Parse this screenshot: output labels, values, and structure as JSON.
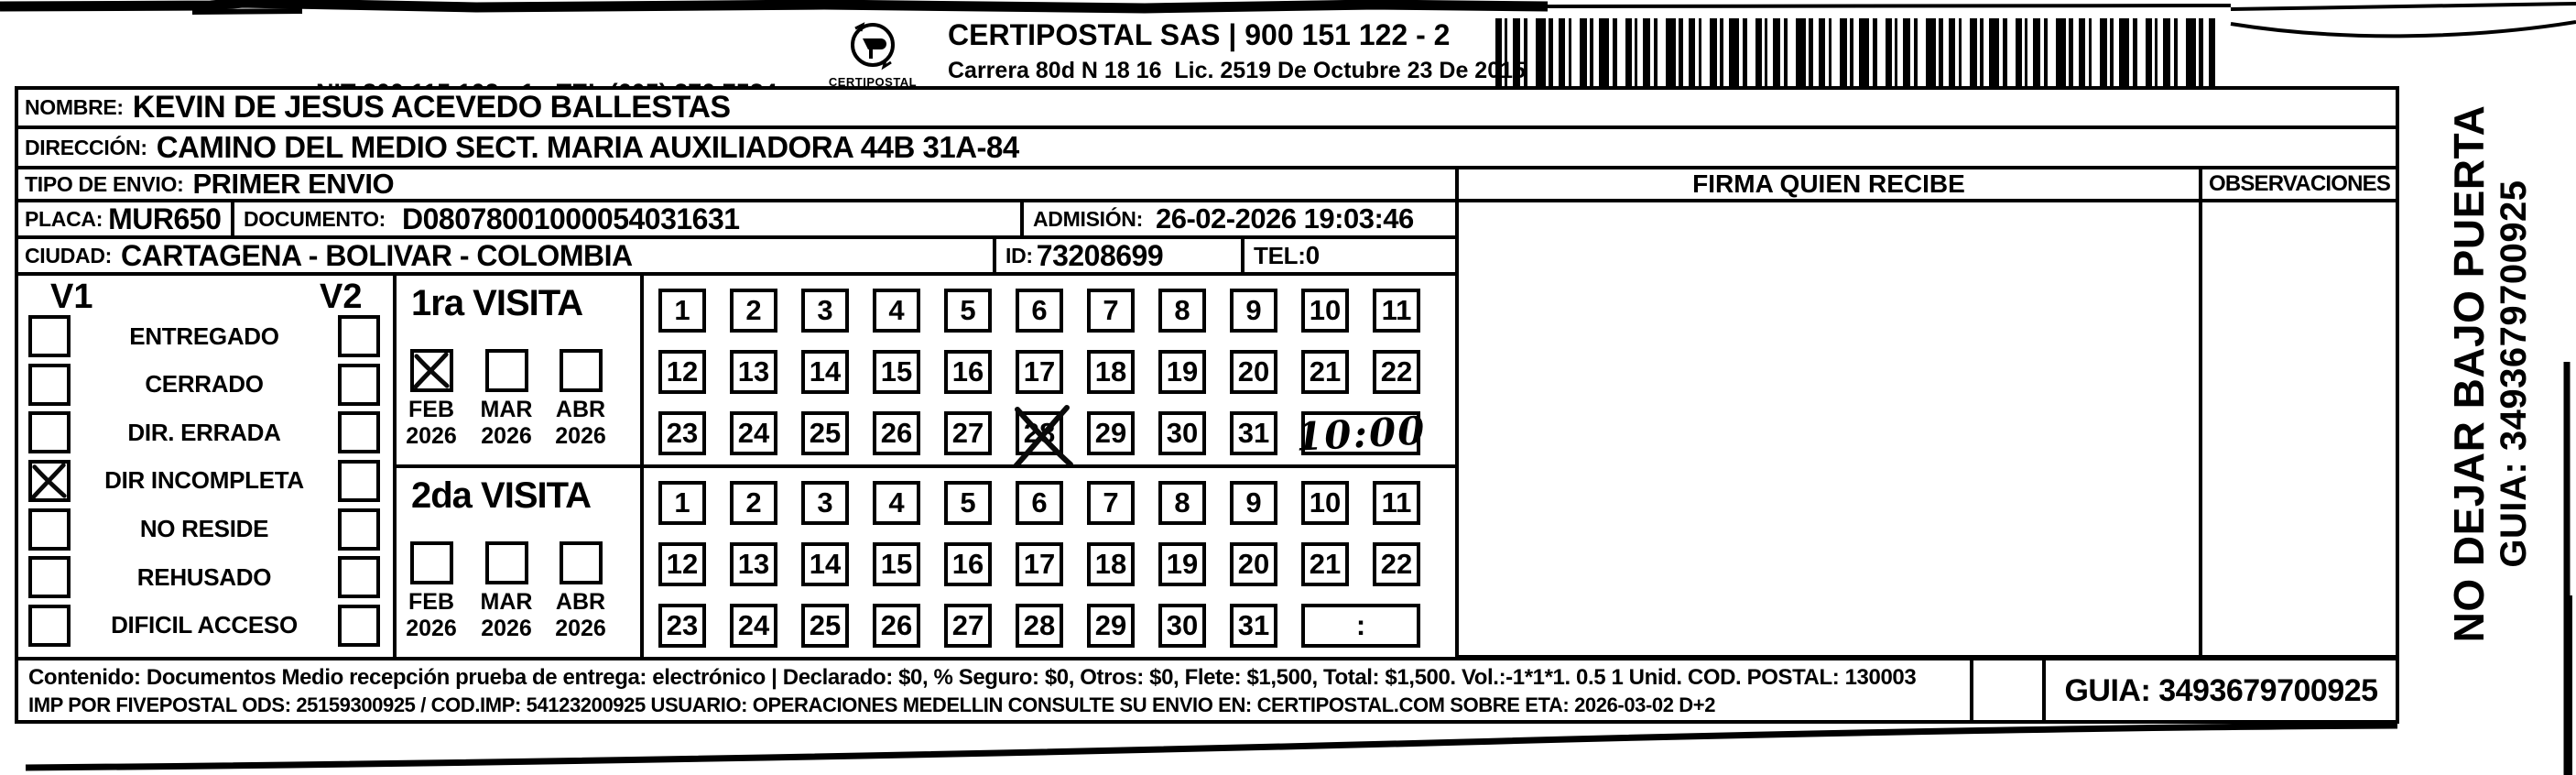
{
  "header": {
    "sender_line1": "TRANSITO DEL",
    "sender_line2": "ATLANTICO",
    "nit_line": "NIT 800 115 102 - 1 - TEL (605) 370 7534",
    "address_line": "CALLE 40 No. 45 06 BARRANQUILLA ATLATICO",
    "logo_text": "CERTIPOSTAL",
    "carrier_line1": "CERTIPOSTAL SAS | 900 151 122 - 2",
    "carrier_line2": "Carrera 80d N 18 16  Lic. 2519 De Octubre 23 De 2015"
  },
  "recipient": {
    "nombre_label": "NOMBRE:",
    "nombre": "KEVIN DE JESUS ACEVEDO BALLESTAS",
    "direccion_label": "DIRECCIÓN:",
    "direccion": "CAMINO DEL MEDIO SECT. MARIA AUXILIADORA 44B 31A-84",
    "tipo_envio_label": "TIPO DE ENVIO:",
    "tipo_envio": "PRIMER ENVIO",
    "placa_label": "PLACA:",
    "placa": "MUR650",
    "documento_label": "DOCUMENTO:",
    "documento": "D08078001000054031631",
    "admision_label": "ADMISIÓN:",
    "admision": "26-02-2026 19:03:46",
    "ciudad_label": "CIUDAD:",
    "ciudad": "CARTAGENA - BOLIVAR - COLOMBIA",
    "id_label": "ID:",
    "id": "73208699",
    "tel_label": "TEL:",
    "tel": "0"
  },
  "columns": {
    "firma_header": "FIRMA QUIEN RECIBE",
    "observaciones_header": "OBSERVACIONES"
  },
  "status": {
    "v1_label": "V1",
    "v2_label": "V2",
    "options": [
      {
        "label": "ENTREGADO",
        "v1_checked": false,
        "v2_checked": false
      },
      {
        "label": "CERRADO",
        "v1_checked": false,
        "v2_checked": false
      },
      {
        "label": "DIR. ERRADA",
        "v1_checked": false,
        "v2_checked": false
      },
      {
        "label": "DIR INCOMPLETA",
        "v1_checked": true,
        "v2_checked": false
      },
      {
        "label": "NO RESIDE",
        "v1_checked": false,
        "v2_checked": false
      },
      {
        "label": "REHUSADO",
        "v1_checked": false,
        "v2_checked": false
      },
      {
        "label": "DIFICIL ACCESO",
        "v1_checked": false,
        "v2_checked": false
      }
    ]
  },
  "visits": [
    {
      "title": "1ra VISITA",
      "months": [
        {
          "month": "FEB",
          "year": "2026",
          "checked": true
        },
        {
          "month": "MAR",
          "year": "2026",
          "checked": false
        },
        {
          "month": "ABR",
          "year": "2026",
          "checked": false
        }
      ],
      "crossed_day": 28,
      "time_written": "10:00"
    },
    {
      "title": "2da VISITA",
      "months": [
        {
          "month": "FEB",
          "year": "2026",
          "checked": false
        },
        {
          "month": "MAR",
          "year": "2026",
          "checked": false
        },
        {
          "month": "ABR",
          "year": "2026",
          "checked": false
        }
      ],
      "crossed_day": null,
      "time_written": ""
    }
  ],
  "calendar": {
    "rows": [
      [
        1,
        2,
        3,
        4,
        5,
        6,
        7,
        8,
        9,
        10,
        11
      ],
      [
        12,
        13,
        14,
        15,
        16,
        17,
        18,
        19,
        20,
        21,
        22
      ],
      [
        23,
        24,
        25,
        26,
        27,
        28,
        29,
        30,
        31
      ]
    ],
    "time_placeholder": ":"
  },
  "side_note": {
    "line1": "NO DEJAR BAJO PUERTA",
    "line2": "GUIA: 3493679700925"
  },
  "footer": {
    "line1": "Contenido: Documentos Medio recepción prueba de entrega: electrónico | Declarado: $0, % Seguro: $0, Otros: $0, Flete: $1,500, Total: $1,500. Vol.:-1*1*1. 0.5  1 Unid. COD. POSTAL: 130003",
    "line2": "IMP POR FIVEPOSTAL ODS: 25159300925 / COD.IMP: 54123200925 USUARIO: OPERACIONES MEDELLIN CONSULTE SU ENVIO EN: CERTIPOSTAL.COM SOBRE ETA: 2026-03-02 D+2",
    "guia": "GUIA: 3493679700925"
  }
}
